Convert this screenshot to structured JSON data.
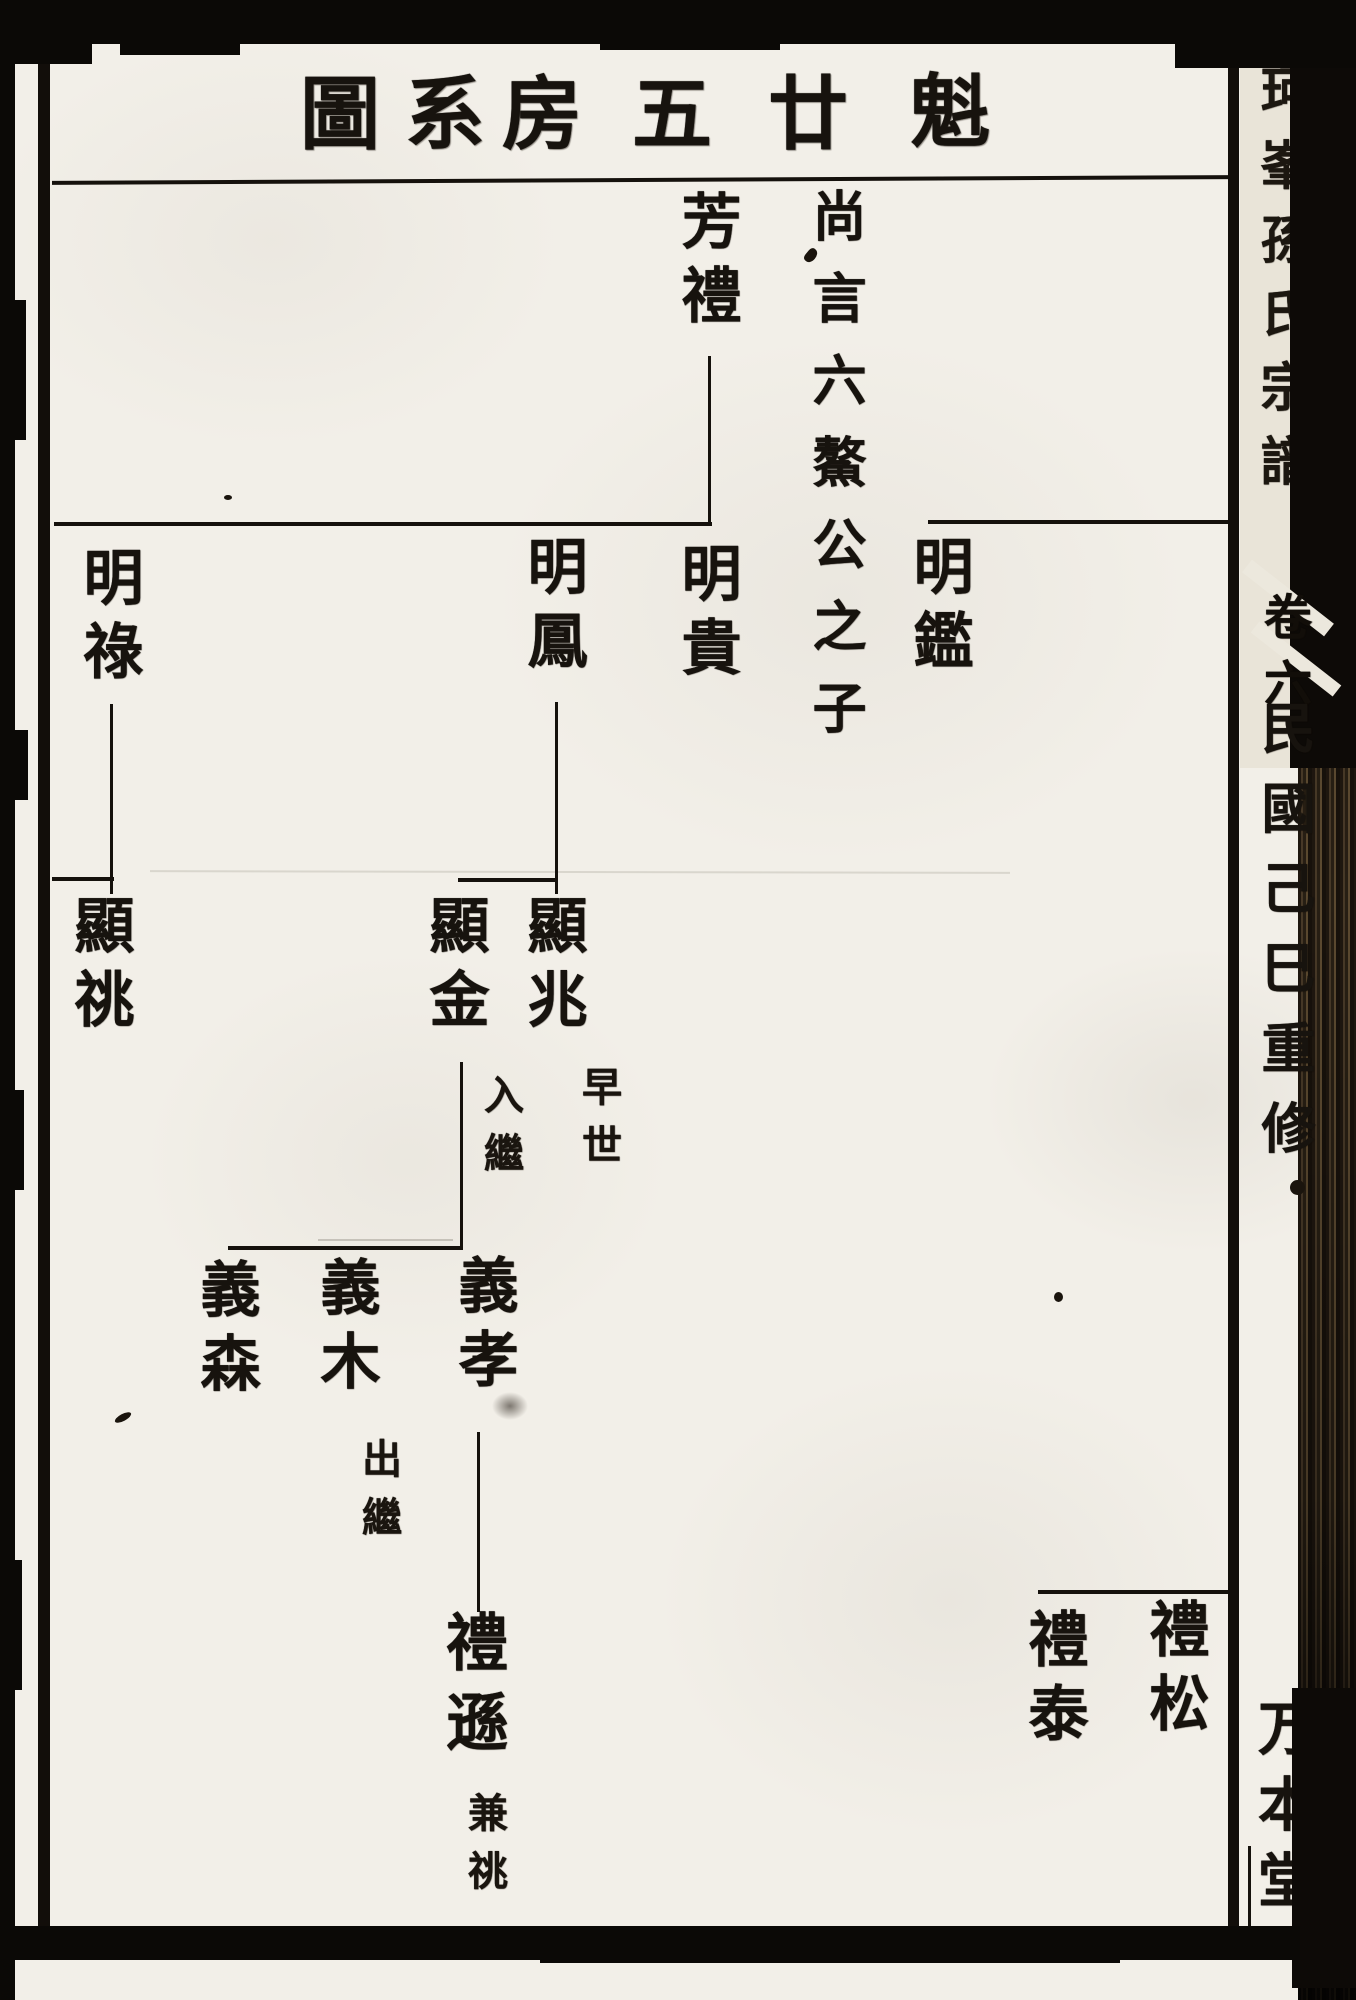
{
  "title": {
    "text_rtl": "魁廿五房系圖",
    "chars": [
      "圖",
      "系",
      "房",
      "五",
      "廿",
      "魁"
    ]
  },
  "tree": {
    "ancestor_note": "尚言六鰲公之子",
    "persons": {
      "fangli": {
        "name": "芳禮"
      },
      "mingjian": {
        "name": "明鑑"
      },
      "minggui": {
        "name": "明貴"
      },
      "mingfeng": {
        "name": "明鳳"
      },
      "minglu": {
        "name": "明祿"
      },
      "xianzhao": {
        "name": "顯兆",
        "note": "早世"
      },
      "xianjin": {
        "name": "顯金",
        "note": "入繼"
      },
      "xiantiao": {
        "name": "顯祧"
      },
      "yixiao": {
        "name": "義孝"
      },
      "yimu": {
        "name": "義木",
        "note": "出繼"
      },
      "yisen": {
        "name": "義森"
      },
      "lixun": {
        "name": "禮遜",
        "note": "兼祧"
      },
      "lisong": {
        "name": "禮松"
      },
      "litai": {
        "name": "禮泰"
      }
    }
  },
  "margin": {
    "spine_title": "珂峯孫氏宗譜",
    "volume_label": "卷六",
    "edition_note": "民國己巳重修",
    "hall_mark": "万本堂"
  }
}
